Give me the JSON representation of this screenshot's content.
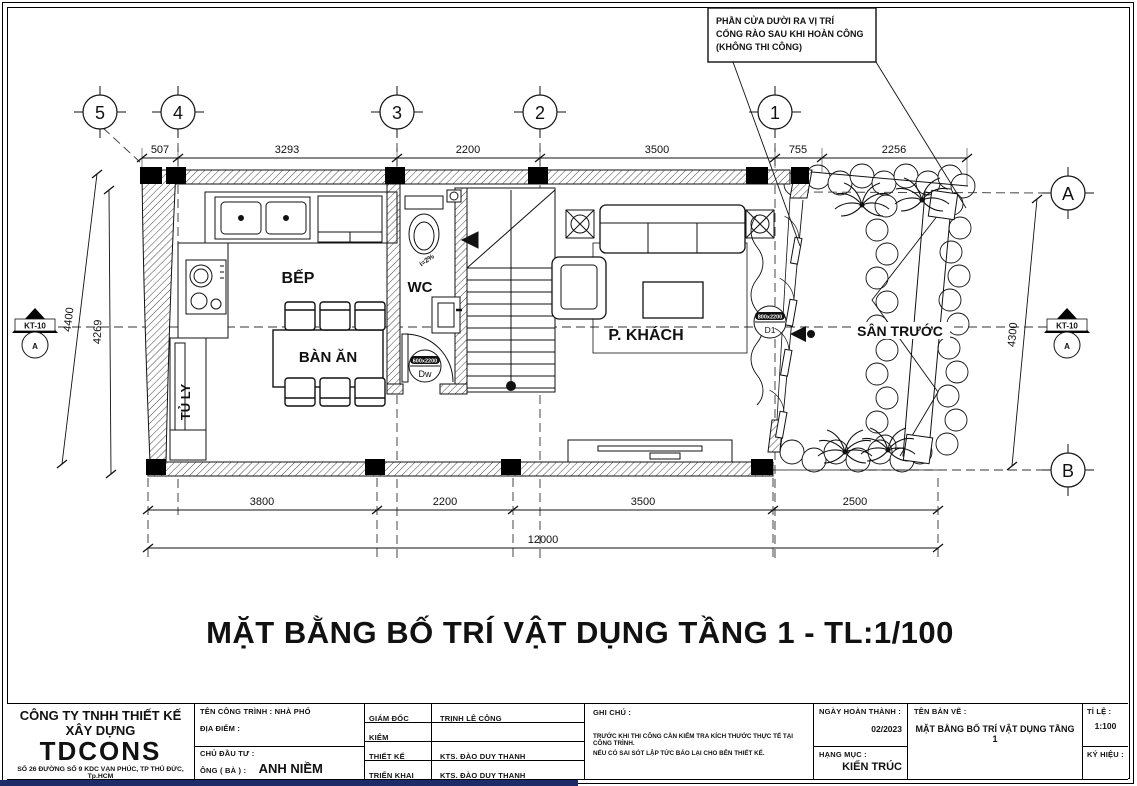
{
  "page": {
    "title": "MẶT BẰNG BỐ TRÍ VẬT DỤNG TẦNG 1 - TL:1/100",
    "colors": {
      "line": "#111111",
      "paper": "#ffffff",
      "accent_blue": "#1d2b69"
    }
  },
  "note_box": {
    "line1": "PHẦN CỬA DƯỜI RA VỊ TRÍ",
    "line2": "CỔNG RÀO SAU KHI HOÀN CÔNG",
    "line3": "(KHÔNG THI CÔNG)"
  },
  "grid": {
    "cols": [
      "5",
      "4",
      "3",
      "2",
      "1"
    ],
    "rows": [
      "A",
      "B"
    ]
  },
  "section_marker": {
    "code": "KT-10",
    "letter": "A"
  },
  "dimensions": {
    "top": [
      "507",
      "3293",
      "2200",
      "3500",
      "755",
      "2256"
    ],
    "bottom": [
      "3800",
      "2200",
      "3500",
      "2500"
    ],
    "bottom_total": "12000",
    "left": [
      "4400",
      "4269"
    ],
    "right": "4300"
  },
  "rooms": {
    "kitchen": "BẾP",
    "wc": "WC",
    "dining": "BÀN ĂN",
    "living": "P. KHÁCH",
    "yard": "SÂN TRƯỚC",
    "cabinet": "TỦ LY"
  },
  "tags": {
    "slope": "i=2%",
    "wc_door_code": "Dw",
    "wc_door_size": "600x2200",
    "main_door_code": "D1",
    "main_door_size": "800x2200"
  },
  "titleblock": {
    "company_type": "CÔNG TY TNHH THIẾT KẾ XÂY DỰNG",
    "company_name": "TDCONS",
    "address": "SỐ 26 ĐƯỜNG SỐ 9 KDC VẠN PHÚC, TP THỦ ĐỨC, Tp.HCM",
    "hotline": "Hotline : 09 779 23 779",
    "email": "Email : cskh.tdcons@gmail.com.",
    "project_label": "TÊN CÔNG TRÌNH : NHÀ PHỐ",
    "location_label": "ĐỊA ĐIỂM :",
    "investor_label": "CHỦ ĐẦU TƯ :",
    "owner_label": "ÔNG ( BÀ ) :",
    "owner_name": "ANH NIỀM",
    "director_label": "GIÁM ĐỐC",
    "director_name": "TRỊNH LÊ CÔNG",
    "check_label": "KIỂM",
    "check_name": "",
    "design_label": "THIẾT KẾ",
    "design_name": "KTS. ĐÀO DUY THANH",
    "deploy_label": "TRIỂN KHAI",
    "deploy_name": "KTS. ĐÀO DUY THANH",
    "notes_label": "GHI CHÚ :",
    "notes_line1": "TRƯỚC KHI THI CÔNG CẦN KIỂM TRA KÍCH THƯỚC THỰC TẾ TẠI CÔNG TRÌNH.",
    "notes_line2": "NẾU CÓ SAI SÓT LẬP TỨC BÁO LẠI CHO BÊN THIẾT KẾ.",
    "date_label": "NGÀY HOÀN THÀNH :",
    "date_value": "02/2023",
    "category_label": "HẠNG MỤC :",
    "category_value": "KIẾN TRÚC",
    "drawing_label": "TÊN BẢN VẼ :",
    "drawing_name": "MẶT BẰNG BỐ TRÍ VẬT DỤNG TẦNG 1",
    "scale_label": "TỈ LỆ :",
    "scale_value": "1:100",
    "symbol_label": "KÝ HIỆU :"
  }
}
